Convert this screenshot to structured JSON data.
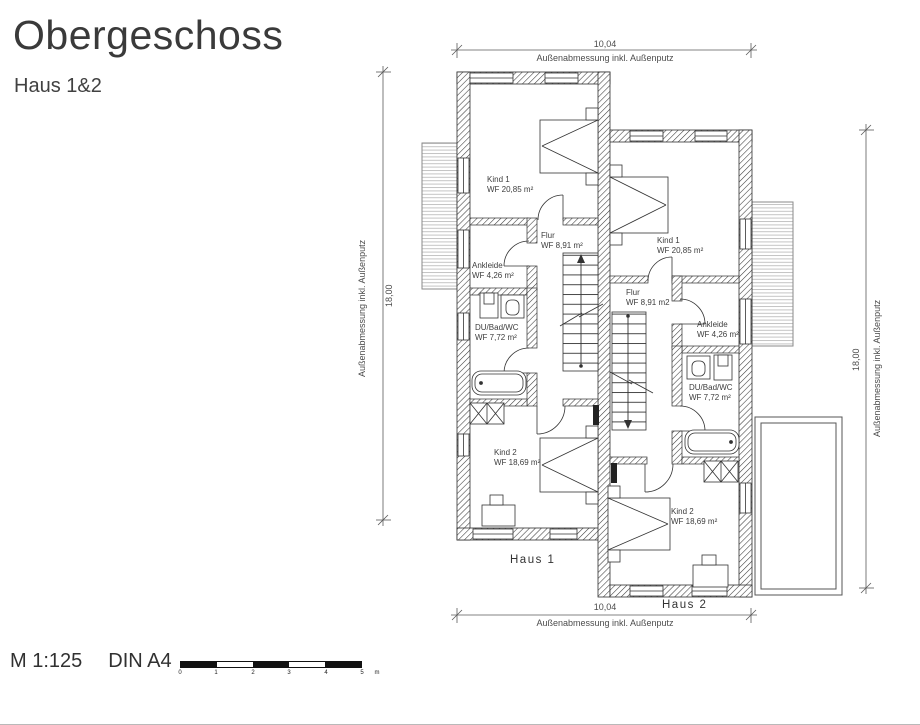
{
  "title": "Obergeschoss",
  "subtitle": "Haus 1&2",
  "dimensions": {
    "top": {
      "value": "10,04",
      "label": "Außenabmessung inkl. Außenputz"
    },
    "bottom": {
      "value": "10,04",
      "label": "Außenabmessung inkl. Außenputz"
    },
    "left": {
      "value": "18,00",
      "label": "Außenabmessung inkl. Außenputz"
    },
    "right": {
      "value": "18,00",
      "label": "Außenabmessung inkl. Außenputz"
    }
  },
  "houses": {
    "haus1": {
      "name": "Haus 1",
      "rooms": {
        "kind1": {
          "name": "Kind 1",
          "area": "WF 20,85 m²"
        },
        "flur": {
          "name": "Flur",
          "area": "WF 8,91 m²"
        },
        "ankleide": {
          "name": "Ankleide",
          "area": "WF 4,26 m²"
        },
        "bad": {
          "name": "DU/Bad/WC",
          "area": "WF 7,72 m²"
        },
        "kind2": {
          "name": "Kind 2",
          "area": "WF 18,69 m²"
        }
      }
    },
    "haus2": {
      "name": "Haus 2",
      "rooms": {
        "kind1": {
          "name": "Kind 1",
          "area": "WF 20,85 m²"
        },
        "flur": {
          "name": "Flur",
          "area": "WF 8,91 m2"
        },
        "ankleide": {
          "name": "Ankleide",
          "area": "WF 4,26 m²"
        },
        "bad": {
          "name": "DU/Bad/WC",
          "area": "WF 7,72 m²"
        },
        "kind2": {
          "name": "Kind 2",
          "area": "WF 18,69 m²"
        }
      }
    }
  },
  "footer": {
    "scale": "M 1:125",
    "format": "DIN A4",
    "ticks": [
      "0",
      "1",
      "2",
      "3",
      "4",
      "5"
    ],
    "unit": "m"
  },
  "colors": {
    "ink": "#2f2f2f",
    "dim": "#555555",
    "text": "#3d3d3d"
  }
}
